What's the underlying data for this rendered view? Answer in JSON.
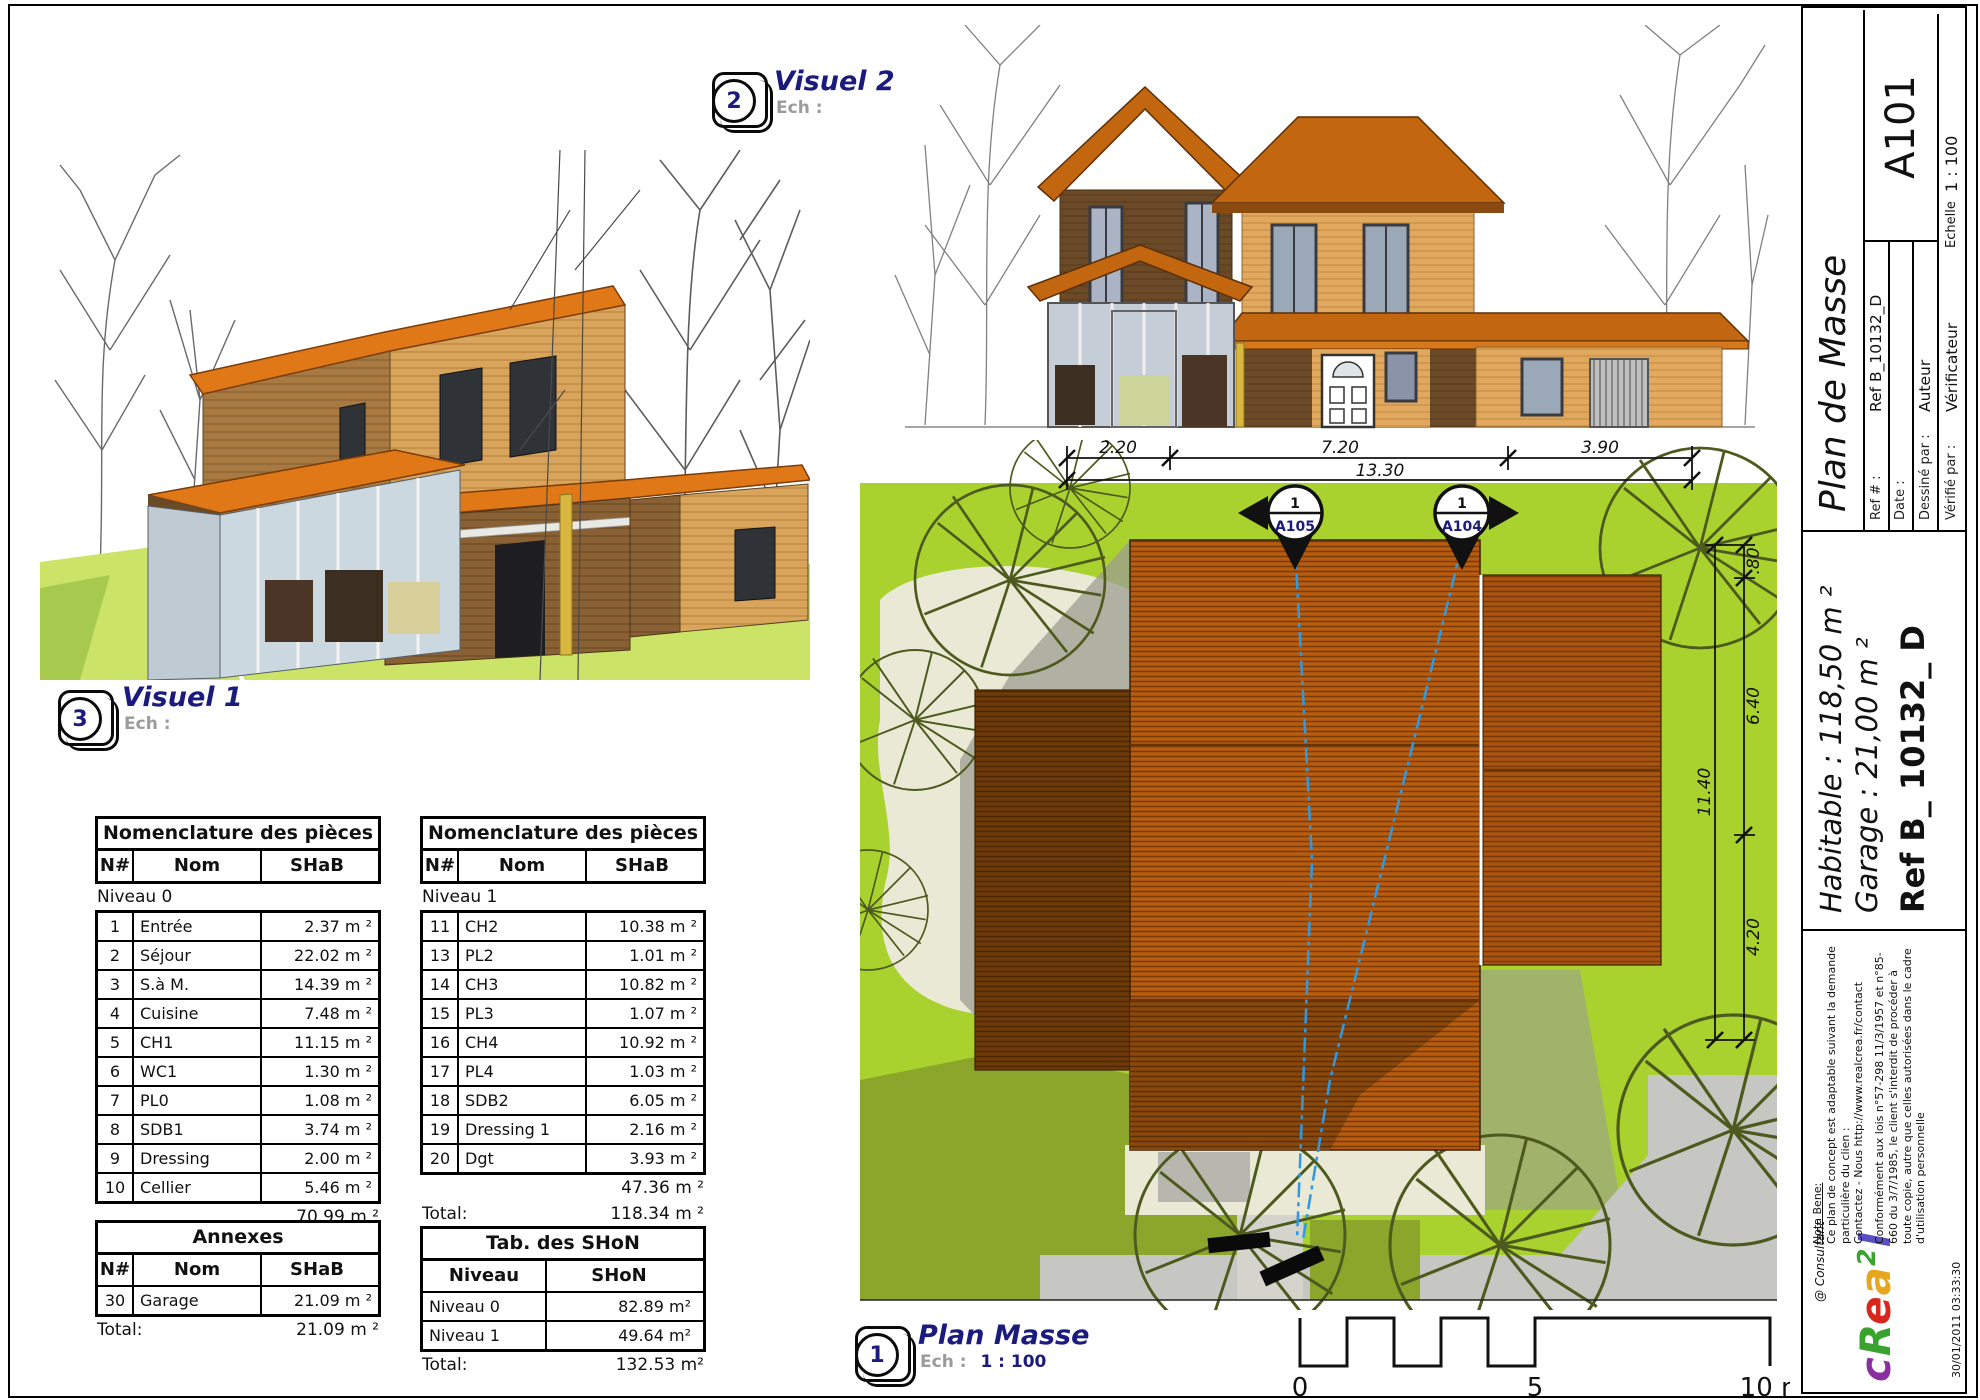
{
  "sheet": {
    "corner_scale": "1 : 100",
    "timestamp": "30/01/2011 03:33:30"
  },
  "viewports": {
    "visuel2": {
      "badge": "2",
      "title": "Visuel 2",
      "ech_label": "Ech :",
      "ech_value": ""
    },
    "visuel1": {
      "badge": "3",
      "title": "Visuel 1",
      "ech_label": "Ech :",
      "ech_value": ""
    },
    "plan_masse": {
      "badge": "1",
      "title": "Plan Masse",
      "ech_label": "Ech :",
      "ech_value": "1 : 100"
    }
  },
  "plan": {
    "dim_top": {
      "seg1": "2.20",
      "seg2": "7.20",
      "seg3": "3.90",
      "total": "13.30"
    },
    "dim_right": {
      "seg1": ".80",
      "seg2": "6.40",
      "seg3": "4.20",
      "total": "11.40"
    },
    "marker_left": {
      "num": "1",
      "ref": "A105"
    },
    "marker_right": {
      "num": "1",
      "ref": "A104"
    },
    "scalebar": {
      "start": "0",
      "mid": "5",
      "end": "10 m"
    }
  },
  "tables": {
    "nomenclature0": {
      "title": "Nomenclature des pièces",
      "cols": [
        "N#",
        "Nom",
        "SHaB"
      ],
      "group": "Niveau 0",
      "rows": [
        [
          "1",
          "Entrée",
          "2.37 m ²"
        ],
        [
          "2",
          "Séjour",
          "22.02 m ²"
        ],
        [
          "3",
          "S.à M.",
          "14.39 m ²"
        ],
        [
          "4",
          "Cuisine",
          "7.48 m ²"
        ],
        [
          "5",
          "CH1",
          "11.15 m ²"
        ],
        [
          "6",
          "WC1",
          "1.30 m ²"
        ],
        [
          "7",
          "PL0",
          "1.08 m ²"
        ],
        [
          "8",
          "SDB1",
          "3.74 m ²"
        ],
        [
          "9",
          "Dressing",
          "2.00 m ²"
        ],
        [
          "10",
          "Cellier",
          "5.46 m ²"
        ]
      ],
      "subtotal": "70.99 m ²"
    },
    "nomenclature1": {
      "title": "Nomenclature des pièces",
      "cols": [
        "N#",
        "Nom",
        "SHaB"
      ],
      "group": "Niveau 1",
      "rows": [
        [
          "11",
          "CH2",
          "10.38 m ²"
        ],
        [
          "13",
          "PL2",
          "1.01 m ²"
        ],
        [
          "14",
          "CH3",
          "10.82 m ²"
        ],
        [
          "15",
          "PL3",
          "1.07 m ²"
        ],
        [
          "16",
          "CH4",
          "10.92 m ²"
        ],
        [
          "17",
          "PL4",
          "1.03 m ²"
        ],
        [
          "18",
          "SDB2",
          "6.05 m ²"
        ],
        [
          "19",
          "Dressing 1",
          "2.16 m ²"
        ],
        [
          "20",
          "Dgt",
          "3.93 m ²"
        ]
      ],
      "subtotal": "47.36 m ²",
      "total_label": "Total:",
      "total": "118.34 m ²"
    },
    "annexes": {
      "title": "Annexes",
      "cols": [
        "N#",
        "Nom",
        "SHaB"
      ],
      "rows": [
        [
          "30",
          "Garage",
          "21.09 m ²"
        ]
      ],
      "total_label": "Total:",
      "total": "21.09 m ²"
    },
    "shon": {
      "title": "Tab. des SHoN",
      "cols": [
        "Niveau",
        "SHoN"
      ],
      "rows": [
        [
          "Niveau 0",
          "82.89 m²"
        ],
        [
          "Niveau 1",
          "49.64 m²"
        ]
      ],
      "total_label": "Total:",
      "total": "132.53 m²"
    }
  },
  "titleblock": {
    "title": "Plan de Masse",
    "sheet_number": "A101",
    "ref_label": "Ref # :",
    "ref_value": "Ref B_10132_D",
    "date_label": "Date :",
    "date_value": "",
    "drawn_label": "Dessiné par :",
    "drawn_value": "Auteur",
    "checked_label": "Vérifié par :",
    "checked_value": "Vérificateur",
    "scale_label": "Echelle",
    "scale_value": "1 : 100",
    "habitable": "Habitable : 118,50 m ²",
    "garage": "Garage : 21,00 m ²",
    "ref_big": "Ref B_ 10132_ D",
    "nota_title": "Nota Bene:",
    "nota_body": "Ce plan de concept est adaptable suivant la demande particulière du clien :",
    "nota_contact": "Contactez - Nous http://www.realcrea.fr/contact",
    "legal": "Conformément aux lois n°57-298 11/3/1957 et n°85-660 du 3/7/1985, le client s'interdit de procéder à toute copie, autre que celles autorisées dans le cadre d'utilisation personnelle",
    "consultant": "@ Consultant",
    "logo": {
      "letters": [
        "c",
        "R",
        "e",
        "a",
        "2",
        "l"
      ],
      "colors": [
        "#8b2fa0",
        "#3aa32f",
        "#d8281e",
        "#e8a51e",
        "#3aa32f",
        "#5a4fc0"
      ]
    }
  },
  "colors": {
    "lawn": "#a9d22f",
    "lawn_dark": "#8ba62b",
    "cream": "#e9e9d6",
    "driveway": "#c6c6c2",
    "roof_main": "#b85c10",
    "roof_stripe": "#7a3c06",
    "roof_left_wing": "#6f3a0a",
    "roof_right_wing": "#aa5410",
    "section_line_blue": "#2e9ae6",
    "label_navy": "#1b1b7e",
    "wall_tan": "#e2a95e",
    "wall_dark_brown": "#6b4a28",
    "roof_orange": "#c2660f"
  }
}
